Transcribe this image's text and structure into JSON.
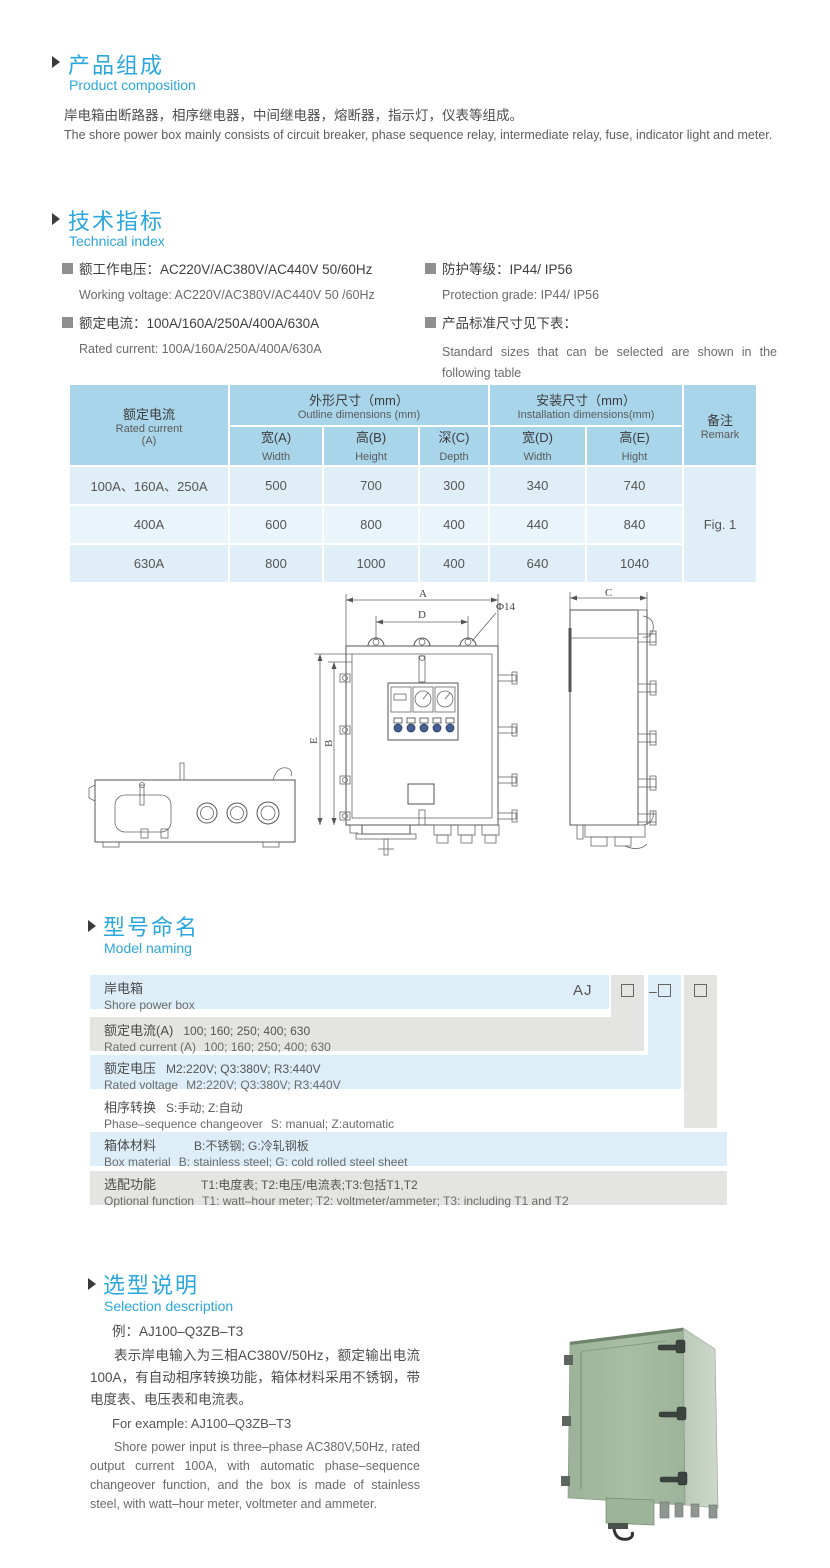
{
  "composition": {
    "title_cn": "产品组成",
    "title_en": "Product  composition",
    "body_cn": "岸电箱由断路器，相序继电器，中间继电器，熔断器，指示灯，仪表等组成。",
    "body_en": "The shore power box mainly consists of circuit breaker, phase sequence relay, intermediate relay, fuse, indicator light and meter."
  },
  "technical": {
    "title_cn": "技术指标",
    "title_en": "Technical index",
    "specs": [
      {
        "cn": "额工作电压：AC220V/AC380V/AC440V  50/60Hz",
        "en": "Working voltage: AC220V/AC380V/AC440V 50 /60Hz"
      },
      {
        "cn": "额定电流：100A/160A/250A/400A/630A",
        "en": "Rated current: 100A/160A/250A/400A/630A"
      },
      {
        "cn": "防护等级：IP44/ IP56",
        "en": "Protection grade: IP44/ IP56"
      },
      {
        "cn": "产品标准尺寸见下表：",
        "en": "Standard sizes that can be selected are shown in the following table"
      }
    ]
  },
  "dims_table": {
    "header": {
      "rated_cn": "额定电流",
      "rated_en": "Rated current",
      "rated_unit": "(A)",
      "outline_cn": "外形尺寸（mm）",
      "outline_en": "Outline dimensions (mm)",
      "install_cn": "安装尺寸（mm）",
      "install_en": "Installation dimensions(mm)",
      "remark_cn": "备注",
      "remark_en": "Remark",
      "col_a_cn": "宽(A)",
      "col_a_en": "Width",
      "col_b_cn": "高(B)",
      "col_b_en": "Height",
      "col_c_cn": "深(C)",
      "col_c_en": "Depth",
      "col_d_cn": "宽(D)",
      "col_d_en": "Width",
      "col_e_cn": "高(E)",
      "col_e_en": "Hight"
    },
    "rows": [
      {
        "current": "100A、160A、250A",
        "w": "500",
        "h": "700",
        "d": "300",
        "iw": "340",
        "ih": "740"
      },
      {
        "current": "400A",
        "w": "600",
        "h": "800",
        "d": "400",
        "iw": "440",
        "ih": "840"
      },
      {
        "current": "630A",
        "w": "800",
        "h": "1000",
        "d": "400",
        "iw": "640",
        "ih": "1040"
      }
    ],
    "remark_value": "Fig. 1"
  },
  "drawing": {
    "dim_a": "A",
    "dim_b": "B",
    "dim_c": "C",
    "dim_d": "D",
    "dim_e": "E",
    "hole": "Φ14"
  },
  "model": {
    "title_cn": "型号命名",
    "title_en": "Model naming",
    "prefix": "AJ",
    "dash": "–",
    "rows": [
      {
        "cn": "岸电箱",
        "cn_detail": "",
        "en": "Shore power box",
        "en_detail": ""
      },
      {
        "cn": "额定电流(A)",
        "cn_detail": "100; 160; 250; 400; 630",
        "en": "Rated current (A)",
        "en_detail": "100; 160; 250; 400; 630"
      },
      {
        "cn": "额定电压",
        "cn_detail": "M2:220V;  Q3:380V;  R3:440V",
        "en": "Rated voltage",
        "en_detail": "M2:220V;  Q3:380V;  R3:440V"
      },
      {
        "cn": "相序转换",
        "cn_detail": "S:手动; Z:自动",
        "en": "Phase–sequence changeover",
        "en_detail": "S: manual;  Z:automatic"
      },
      {
        "cn": "箱体材料",
        "cn_detail": "B:不锈钢;  G:冷轧钢板",
        "en": "Box material",
        "en_detail": "B: stainless steel; G: cold rolled steel sheet"
      },
      {
        "cn": "选配功能",
        "cn_detail": "T1:电度表;  T2:电压/电流表;T3:包括T1,T2",
        "en": "Optional function",
        "en_detail": "T1: watt–hour meter; T2: voltmeter/ammeter; T3: including T1 and T2"
      }
    ]
  },
  "selection": {
    "title_cn": "选型说明",
    "title_en": "Selection description",
    "example_cn": "例：AJ100–Q3ZB–T3",
    "body_cn": "表示岸电输入为三相AC380V/50Hz，额定输出电流100A，有自动相序转换功能，箱体材料采用不锈钢，带电度表、电压表和电流表。",
    "example_en": "For example: AJ100–Q3ZB–T3",
    "body_en": "Shore power input is three–phase AC380V,50Hz, rated output current 100A, with automatic phase–sequence changeover function, and the box is made of stainless steel, with watt–hour meter, voltmeter and ammeter."
  },
  "colors": {
    "accent_blue": "#2aa7de",
    "table_header": "#a9d5ea",
    "band_blue": "#ddeef8",
    "band_gray": "#e4e4e3",
    "product_green": "#a3bba0"
  }
}
